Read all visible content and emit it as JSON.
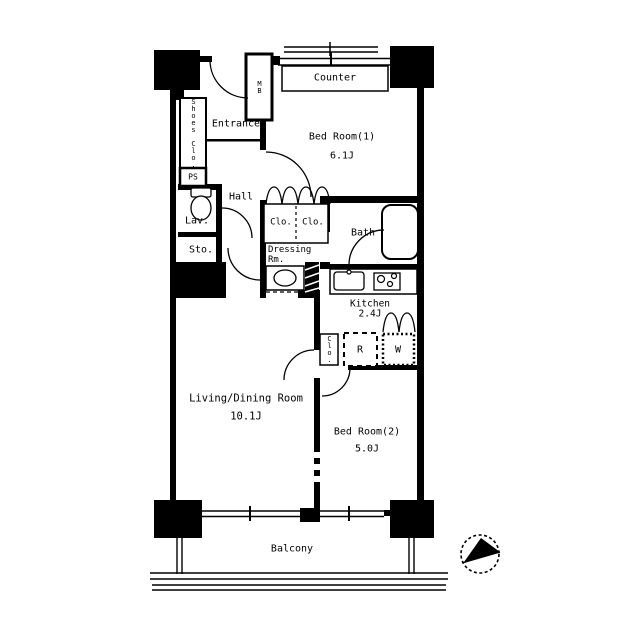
{
  "rooms": {
    "bedroom1": {
      "name": "Bed Room(1)",
      "size": "6.1J"
    },
    "bedroom2": {
      "name": "Bed Room(2)",
      "size": "5.0J"
    },
    "living_dining": {
      "name": "Living/Dining Room",
      "size": "10.1J"
    },
    "kitchen": {
      "name": "Kitchen",
      "size": "2.4J"
    },
    "bath": {
      "name": "Bath"
    },
    "dressing_room": {
      "line1": "Dressing",
      "line2": "Rm."
    },
    "hall": {
      "name": "Hall"
    },
    "entrance": {
      "name": "Entrance"
    },
    "lavatory": {
      "name": "Lav."
    },
    "storage": {
      "name": "Sto."
    },
    "balcony": {
      "name": "Balcony"
    }
  },
  "features": {
    "counter": "Counter",
    "shoes_closet": "Shoes Clo.",
    "closet_1": "Clo.",
    "closet_2": "Clo.",
    "kitchen_closet": "Clo.",
    "meter_box": "MB",
    "pipe_space": "PS",
    "refrigerator": "R",
    "washing_machine": "W"
  },
  "colors": {
    "line": "#000000",
    "background": "#ffffff"
  }
}
